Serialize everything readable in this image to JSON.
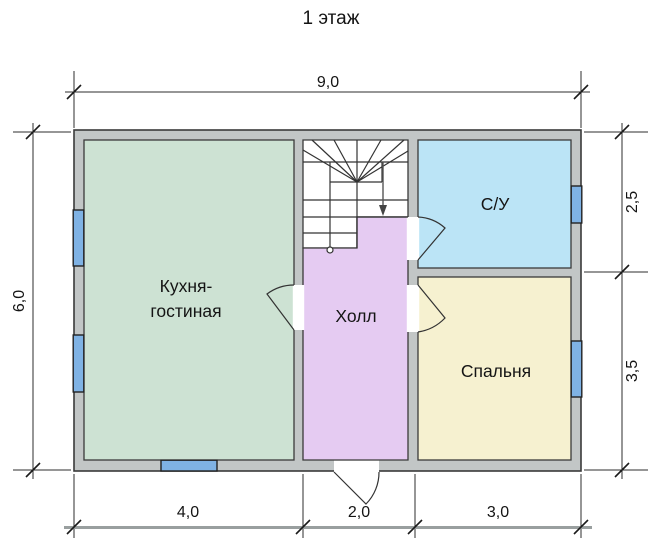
{
  "title": "1 этаж",
  "rooms": [
    {
      "name": "kitchen-living",
      "label_line1": "Кухня-",
      "label_line2": "гостиная",
      "fill": "#cde2d3"
    },
    {
      "name": "hall",
      "label": "Холл",
      "fill": "#e5cbf2"
    },
    {
      "name": "bathroom",
      "label": "С/У",
      "fill": "#bbe4f6"
    },
    {
      "name": "bedroom",
      "label": "Спальня",
      "fill": "#f6f1d0"
    }
  ],
  "dimensions": {
    "top": "9,0",
    "left": "6,0",
    "right": [
      "2,5",
      "3,5"
    ],
    "bottom": [
      "4,0",
      "2,0",
      "3,0"
    ]
  },
  "colors": {
    "wall_fill": "#c2c6c6",
    "window_fill": "#7fb2e4",
    "stair_fill": "#ffffff",
    "dim_line": "#999f9f",
    "outline": "#3a3a3a"
  }
}
